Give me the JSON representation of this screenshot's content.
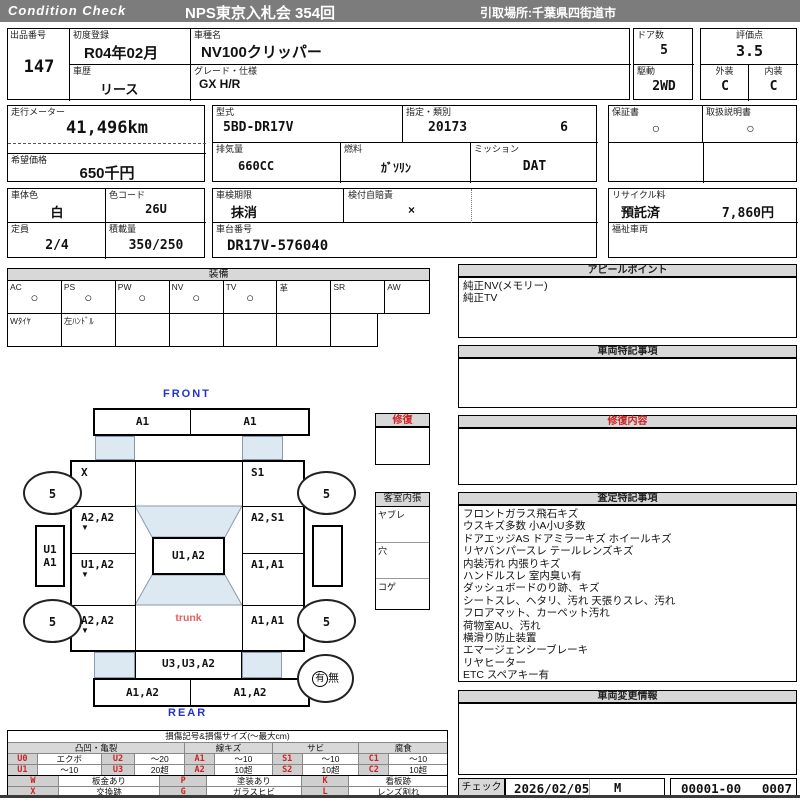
{
  "colors": {
    "topbar_gray": "#7c7c7c",
    "section_header_gray": "#d8d8d8",
    "accent_blue": "#2233cc",
    "accent_red": "#cc2222",
    "trunk_red": "#e06060",
    "glass_blue": "#dce8f2"
  },
  "header": {
    "brand": "Condition Check",
    "title": "NPS東京入札会 354回",
    "pickup": "引取場所:千葉県四街道市"
  },
  "info": {
    "lot_label": "出品番号",
    "lot": "147",
    "first_reg_label": "初度登録",
    "first_reg": "R04年02月",
    "history_label": "車歴",
    "history": "リース",
    "model_label": "車種名",
    "model": "NV100クリッパー",
    "grade_label": "グレード・仕様",
    "grade": "GX H/R",
    "doors_label": "ドア数",
    "doors": "5",
    "drive_label": "駆動",
    "drive": "2WD",
    "score_label": "評価点",
    "score": "3.5",
    "exterior_label": "外装",
    "exterior": "C",
    "interior_label": "内装",
    "interior": "C",
    "odo_label": "走行メーター",
    "odo": "41,496km",
    "price_label": "希望価格",
    "price": "650千円",
    "model_code_label": "型式",
    "model_code": "5BD-DR17V",
    "type_class_label": "指定・類別",
    "type_no": "20173",
    "class_no": "6",
    "displacement_label": "排気量",
    "displacement": "660CC",
    "fuel_label": "燃料",
    "fuel": "ｶﾞｿﾘﾝ",
    "mission_label": "ミッション",
    "mission": "DAT",
    "warranty_label": "保証書",
    "warranty": "○",
    "manual_label": "取扱説明書",
    "manual": "○",
    "body_color_label": "車体色",
    "body_color": "白",
    "color_code_label": "色コード",
    "color_code": "26U",
    "inspection_label": "車検期限",
    "inspection": "抹消",
    "insurance_label": "検付自賠責",
    "insurance": "×",
    "recycle_label": "リサイクル料",
    "recycle_status": "預託済",
    "recycle_fee": "7,860円",
    "capacity_label": "定員",
    "capacity": "2/4",
    "load_label": "積載量",
    "load": "350/250",
    "vin_label": "車台番号",
    "vin": "DR17V-576040",
    "welfare_label": "福祉車両"
  },
  "equipment": {
    "title": "装備",
    "items": [
      {
        "label": "AC",
        "mark": "○"
      },
      {
        "label": "PS",
        "mark": "○"
      },
      {
        "label": "PW",
        "mark": "○"
      },
      {
        "label": "NV",
        "mark": "○"
      },
      {
        "label": "TV",
        "mark": "○"
      },
      {
        "label": "革",
        "mark": ""
      },
      {
        "label": "SR",
        "mark": ""
      },
      {
        "label": "AW",
        "mark": ""
      }
    ],
    "extras": [
      "Wﾀｲﾔ",
      "左ﾊﾝﾄﾞﾙ",
      "",
      "",
      "",
      "",
      ""
    ]
  },
  "appeal": {
    "title": "アピールポイント",
    "lines": [
      "純正NV(メモリー)",
      "純正TV"
    ]
  },
  "vehicle_notes": {
    "title": "車両特記事項"
  },
  "repair_content": {
    "title": "修復内容"
  },
  "assessment": {
    "title": "査定特記事項",
    "lines": [
      "フロントガラス飛石キズ",
      "ウスキズ多数 小A小U多数",
      "ドアエッジAS ドアミラーキズ ホイールキズ",
      "リヤバンパースレ テールレンズキズ",
      "内装汚れ 内張りキズ",
      "ハンドルスレ 室内臭い有",
      "ダッシュボードのり跡、キズ",
      "シートスレ、ヘタリ、汚れ 天張りスレ、汚れ",
      "フロアマット、カーペット汚れ",
      "荷物室AU、汚れ",
      "横滑り防止装置",
      "エマージェンシーブレーキ",
      "リヤヒーター",
      "ETC スペアキー有"
    ]
  },
  "change_info": {
    "title": "車両変更情報"
  },
  "check": {
    "label": "チェック",
    "date": "2026/02/05",
    "mark": "M",
    "number": "00001-00",
    "count": "0007"
  },
  "repair_box": {
    "title": "修復"
  },
  "cabin": {
    "title": "客室内張",
    "rows": [
      "ヤブレ",
      "穴",
      "コゲ"
    ]
  },
  "diagram": {
    "front_label": "FRONT",
    "rear_label": "REAR",
    "trunk_label": "trunk",
    "wheel": "5",
    "front_bumper_left": "A1",
    "front_bumper_right": "A1",
    "fender_left": "X",
    "fender_right": "S1",
    "door_front_left": "A2,A2",
    "door_front_right": "A2,S1",
    "panel_mid_left": "U1,A2",
    "panel_mid_right": "A1,A1",
    "quarter_left": "A2,A2",
    "quarter_right": "A1,A1",
    "roof": "U1,A2",
    "hatch": "U3,U3,A2",
    "rear_bumper_left": "A1,A2",
    "rear_bumper_right": "A1,A2",
    "side_left_top": "U1",
    "side_left_bottom": "A1",
    "panel_mark": "▼",
    "spare_yes": "有",
    "spare_no": "無"
  },
  "legend": {
    "title": "損傷記号&損傷サイズ(〜最大cm)",
    "groups": [
      "凸凹・亀裂",
      "線キズ",
      "サビ",
      "腐食"
    ],
    "rows": [
      [
        {
          "code": "U0",
          "val": "エクボ"
        },
        {
          "code": "U2",
          "val": "〜20"
        },
        {
          "code": "A1",
          "val": "〜10"
        },
        {
          "code": "S1",
          "val": "〜10"
        },
        {
          "code": "C1",
          "val": "〜10"
        }
      ],
      [
        {
          "code": "U1",
          "val": "〜10"
        },
        {
          "code": "U3",
          "val": "20超"
        },
        {
          "code": "A2",
          "val": "10超"
        },
        {
          "code": "S2",
          "val": "10超"
        },
        {
          "code": "C2",
          "val": "10超"
        }
      ]
    ],
    "marks": [
      [
        {
          "code": "W",
          "val": "板金あり"
        },
        {
          "code": "P",
          "val": "塗装あり"
        },
        {
          "code": "K",
          "val": "看板跡"
        }
      ],
      [
        {
          "code": "X",
          "val": "交換跡"
        },
        {
          "code": "G",
          "val": "ガラスヒビ"
        },
        {
          "code": "L",
          "val": "レンズ割れ"
        }
      ]
    ]
  }
}
